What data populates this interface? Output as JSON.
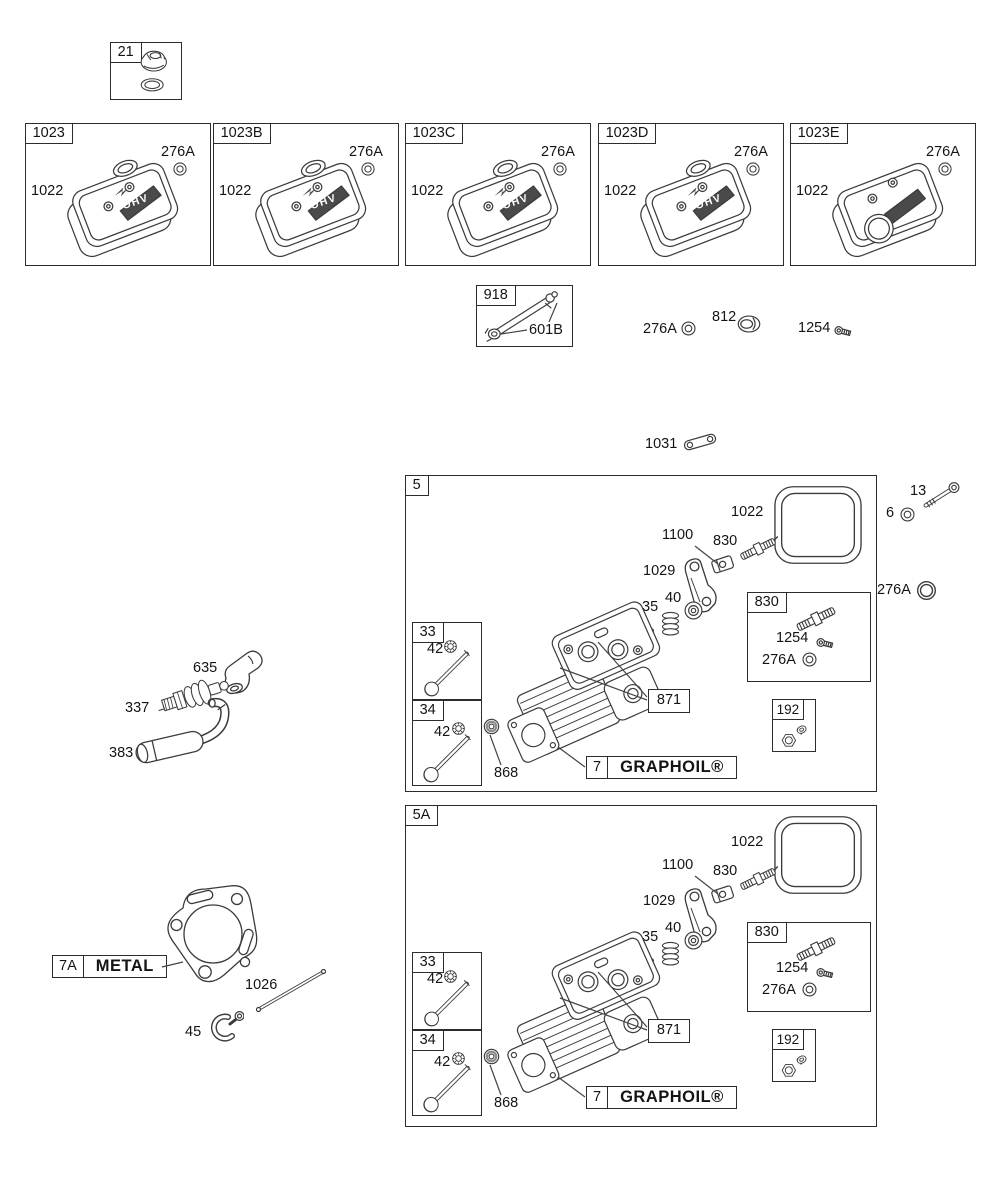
{
  "cap_kit": {
    "id": "21"
  },
  "cover_kits": [
    {
      "id": "1023",
      "cover": "1022",
      "washer": "276A",
      "badge": "OHV"
    },
    {
      "id": "1023B",
      "cover": "1022",
      "washer": "276A",
      "badge": "OHV"
    },
    {
      "id": "1023C",
      "cover": "1022",
      "washer": "276A",
      "badge": "OHV"
    },
    {
      "id": "1023D",
      "cover": "1022",
      "washer": "276A",
      "badge": "OHV"
    },
    {
      "id": "1023E",
      "cover": "1022",
      "washer": "276A",
      "badge": ""
    }
  ],
  "rod_kit": {
    "id": "918",
    "fitting": "601B"
  },
  "loose_parts": {
    "washer": "276A",
    "plug": "812",
    "screw": "1254",
    "link": "1031"
  },
  "side_parts": {
    "bolt": "13",
    "washer": "6",
    "ring": "276A"
  },
  "head_assemblies": [
    {
      "id": "5",
      "gasket": "1022",
      "pivot": "1100",
      "stud": "830",
      "rocker": "1029",
      "retainer": "40",
      "spring": "35",
      "guide": "36",
      "stud_kit": {
        "id": "830",
        "screw": "1254",
        "washer": "276A"
      },
      "head_ref": "871",
      "intake_kit": {
        "id": "33",
        "seal": "42"
      },
      "exhaust_kit": {
        "id": "34",
        "seal": "42"
      },
      "valve_seal": "868",
      "gasket_label": {
        "ref": "7",
        "name": "GRAPHOIL®"
      },
      "nut_kit": {
        "id": "192"
      }
    },
    {
      "id": "5A",
      "gasket": "1022",
      "pivot": "1100",
      "stud": "830",
      "rocker": "1029",
      "retainer": "40",
      "spring": "35",
      "guide": "36",
      "stud_kit": {
        "id": "830",
        "screw": "1254",
        "washer": "276A"
      },
      "head_ref": "871",
      "intake_kit": {
        "id": "33",
        "seal": "42"
      },
      "exhaust_kit": {
        "id": "34",
        "seal": "42"
      },
      "valve_seal": "868",
      "gasket_label": {
        "ref": "7",
        "name": "GRAPHOIL®"
      },
      "nut_kit": {
        "id": "192"
      }
    }
  ],
  "ignition": {
    "boot": "635",
    "spark_plug": "337",
    "breather_tube": "383"
  },
  "cylinder_gasket": {
    "ref": "7A",
    "name": "METAL",
    "push_rod": "1026",
    "clamp": "45"
  }
}
